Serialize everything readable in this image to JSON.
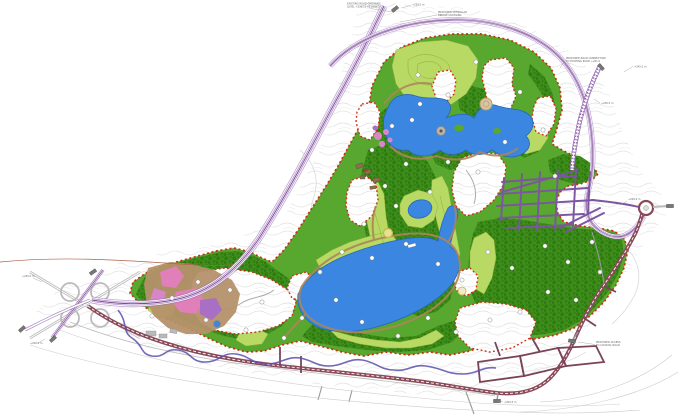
{
  "map": {
    "type": "landscape-masterplan",
    "title": "park-and-lakes-master-plan",
    "palette": {
      "water": "#3a86e0",
      "waterEdge": "#2a66b8",
      "greenBase": "#58a72e",
      "forestFill": "#3f8f1c",
      "lawn": "#b8d964",
      "lawnEdge": "#95b23c",
      "boundary": "#cc2d12",
      "corridor": "#9b72b8",
      "corridorDark": "#7d4596",
      "ladder": "#8a5aa6",
      "grid": "#7d55a0",
      "street": "#7a4458",
      "mainRoad": "#8a4a5a",
      "roadGray": "#bbbbbb",
      "minor": "#999999",
      "contour": "#d9d9d9",
      "tanArea": "#b5916a",
      "tanPath": "#ad855a",
      "pink": "#e07fb8",
      "pinkLight": "#d886c8",
      "purpleFeature": "#a86fc4",
      "stream": "#5b4fae",
      "redLine": "#b06048",
      "building": "#8a6f4f",
      "grayBuilding": "#b9b9b9",
      "stub": "#777777",
      "annotation": "#666666"
    },
    "annotations": [
      {
        "x": 347,
        "y": 4.5,
        "size": 2.5,
        "anchor": "start",
        "text": "EXISTING ROAD CROSSING"
      },
      {
        "x": 347,
        "y": 7.6,
        "size": 2.5,
        "anchor": "start",
        "text": "LEVEL +236.50 RETAINED"
      },
      {
        "x": 412,
        "y": 5.5,
        "size": 2.5,
        "anchor": "start",
        "text": "+238.0 m"
      },
      {
        "x": 438,
        "y": 13,
        "size": 2.5,
        "anchor": "start",
        "text": "PROPOSED VEHICULAR"
      },
      {
        "x": 438,
        "y": 16.2,
        "size": 2.5,
        "anchor": "start",
        "text": "BRIDGE CROSSING"
      },
      {
        "x": 566,
        "y": 59,
        "size": 2.5,
        "anchor": "start",
        "text": "PROPOSED ROAD CONNECTION"
      },
      {
        "x": 566,
        "y": 62.2,
        "size": 2.5,
        "anchor": "start",
        "text": "TO EXISTING ROAD +241.0"
      },
      {
        "x": 634,
        "y": 67.5,
        "size": 2.5,
        "anchor": "start",
        "text": "+245.0 m"
      },
      {
        "x": 601,
        "y": 104,
        "size": 2.5,
        "anchor": "start",
        "text": "+236.5 m"
      },
      {
        "x": 628,
        "y": 200,
        "size": 2.5,
        "anchor": "start",
        "text": "+228.4 m"
      },
      {
        "x": 596,
        "y": 343,
        "size": 2.5,
        "anchor": "start",
        "text": "PROPOSED ACCESS"
      },
      {
        "x": 596,
        "y": 346.2,
        "size": 2.5,
        "anchor": "start",
        "text": "TO COASTAL ROAD"
      },
      {
        "x": 504,
        "y": 403,
        "size": 2.5,
        "anchor": "start",
        "text": "+209.5 m"
      },
      {
        "x": 22,
        "y": 277,
        "size": 2.5,
        "anchor": "start",
        "text": "+230.0 m"
      },
      {
        "x": 30,
        "y": 344,
        "size": 2.5,
        "anchor": "start",
        "text": "+226.0 m"
      }
    ],
    "keyed_note_markers": [
      [
        418,
        75
      ],
      [
        448,
        95
      ],
      [
        476,
        62
      ],
      [
        520,
        92
      ],
      [
        543,
        130
      ],
      [
        420,
        104
      ],
      [
        392,
        126
      ],
      [
        372,
        150
      ],
      [
        406,
        164
      ],
      [
        448,
        162
      ],
      [
        478,
        172
      ],
      [
        430,
        192
      ],
      [
        396,
        206
      ],
      [
        364,
        224
      ],
      [
        342,
        252
      ],
      [
        320,
        272
      ],
      [
        372,
        258
      ],
      [
        406,
        244
      ],
      [
        438,
        264
      ],
      [
        462,
        280
      ],
      [
        488,
        252
      ],
      [
        512,
        268
      ],
      [
        545,
        246
      ],
      [
        568,
        262
      ],
      [
        592,
        242
      ],
      [
        336,
        300
      ],
      [
        362,
        322
      ],
      [
        398,
        336
      ],
      [
        428,
        318
      ],
      [
        456,
        332
      ],
      [
        302,
        318
      ],
      [
        262,
        302
      ],
      [
        230,
        290
      ],
      [
        198,
        282
      ],
      [
        172,
        298
      ],
      [
        152,
        316
      ],
      [
        206,
        320
      ],
      [
        246,
        330
      ],
      [
        284,
        338
      ],
      [
        490,
        320
      ],
      [
        520,
        312
      ],
      [
        548,
        292
      ],
      [
        576,
        300
      ],
      [
        600,
        272
      ],
      [
        505,
        142
      ],
      [
        555,
        176
      ],
      [
        412,
        120
      ],
      [
        385,
        186
      ]
    ]
  }
}
